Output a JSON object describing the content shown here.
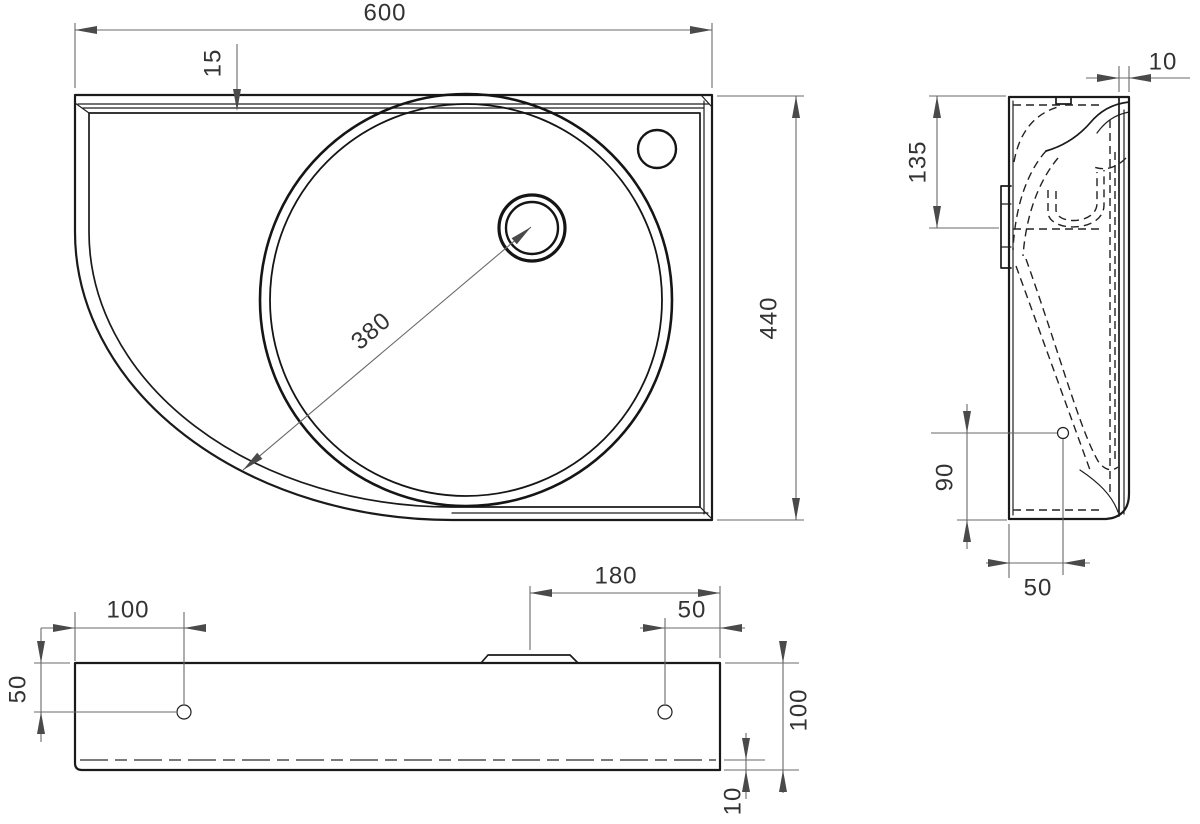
{
  "drawing": {
    "colors": {
      "background": "#ffffff",
      "object_line": "#1a1a1a",
      "hidden_line": "#222222",
      "dimension_line": "#6a6a6a",
      "dimension_text": "#333333"
    }
  },
  "views": {
    "plan": {
      "dims": {
        "overall_width": "600",
        "backsplash_depth": "15",
        "overall_depth": "440",
        "basin_diameter": "380"
      }
    },
    "side": {
      "dims": {
        "front_rim_thickness": "10",
        "bracket_height": "135",
        "hole_from_bottom": "90",
        "hole_from_front": "50"
      }
    },
    "front": {
      "dims": {
        "left_hole_offset": "100",
        "hole_drop": "50",
        "drain_to_right_edge": "180",
        "right_hole_offset": "50",
        "apron_height": "100",
        "bottom_lip": "10"
      }
    }
  }
}
